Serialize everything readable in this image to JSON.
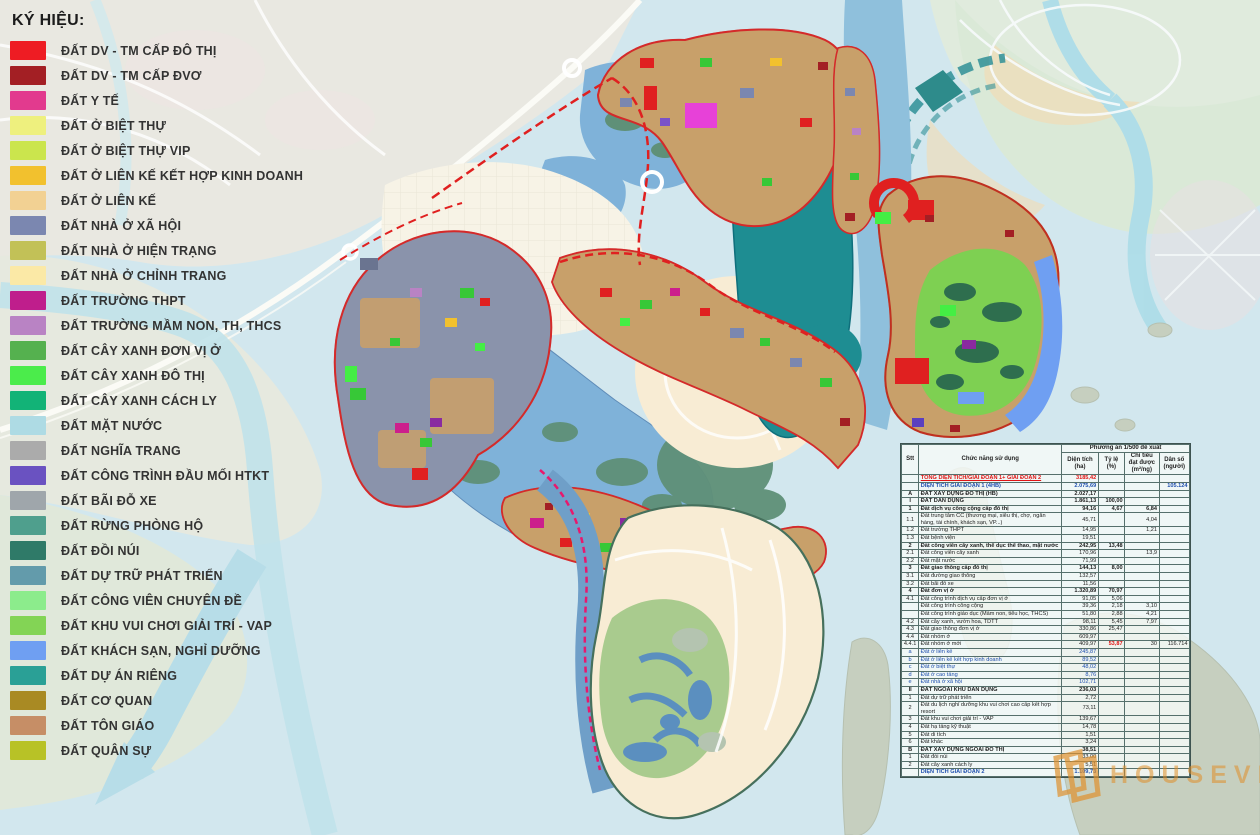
{
  "legend": {
    "title": "KÝ HIỆU:",
    "items": [
      {
        "label": "ĐẤT DV - TM CẤP ĐÔ THỊ",
        "color": "#ee1c23"
      },
      {
        "label": "ĐẤT DV - TM CẤP ĐVƠ",
        "color": "#a31f24"
      },
      {
        "label": "ĐẤT Y TẾ",
        "color": "#e23a8e"
      },
      {
        "label": "ĐẤT Ở BIỆT THỰ",
        "color": "#eef07e"
      },
      {
        "label": "ĐẤT Ở BIỆT THỰ VIP",
        "color": "#cbe54d"
      },
      {
        "label": "ĐẤT Ở LIÊN KẾ KẾT HỢP KINH DOANH",
        "color": "#f2c12e"
      },
      {
        "label": "ĐẤT Ở LIÊN KẾ",
        "color": "#f2d193"
      },
      {
        "label": "ĐẤT NHÀ Ở XÃ HỘI",
        "color": "#7b87b0"
      },
      {
        "label": "ĐẤT NHÀ Ở HIỆN TRẠNG",
        "color": "#c2c157"
      },
      {
        "label": "ĐẤT NHÀ Ở CHỈNH TRANG",
        "color": "#fbe9a6"
      },
      {
        "label": "ĐẤT TRƯỜNG THPT",
        "color": "#bf1e8c"
      },
      {
        "label": "ĐẤT TRƯỜNG MẦM NON, TH, THCS",
        "color": "#b983c4"
      },
      {
        "label": "ĐẤT CÂY XANH ĐƠN VỊ Ở",
        "color": "#55b14f"
      },
      {
        "label": "ĐẤT CÂY XANH ĐÔ THỊ",
        "color": "#4bec4b"
      },
      {
        "label": "ĐẤT CÂY XANH CÁCH LY",
        "color": "#12b377"
      },
      {
        "label": "ĐẤT MẶT NƯỚC",
        "color": "#aedbe4"
      },
      {
        "label": "ĐẤT NGHĨA TRANG",
        "color": "#ababab"
      },
      {
        "label": "ĐẤT CÔNG TRÌNH ĐẦU MỐI HTKT",
        "color": "#6a52c1"
      },
      {
        "label": "ĐẤT BÃI ĐỖ XE",
        "color": "#9fa6ab"
      },
      {
        "label": "ĐẤT RỪNG PHÒNG HỘ",
        "color": "#4f9f8d"
      },
      {
        "label": "ĐẤT ĐỒI NÚI",
        "color": "#2f7a68"
      },
      {
        "label": "ĐẤT DỰ TRỮ PHÁT TRIỂN",
        "color": "#639bab"
      },
      {
        "label": "ĐẤT CÔNG VIÊN CHUYÊN ĐỀ",
        "color": "#8cec8c"
      },
      {
        "label": "ĐẤT KHU VUI CHƠI GIẢI TRÍ - VAP",
        "color": "#83d455"
      },
      {
        "label": "ĐẤT KHÁCH SẠN, NGHỈ DƯỠNG",
        "color": "#6f9ff2"
      },
      {
        "label": "ĐẤT DỰ ÁN RIÊNG",
        "color": "#2aa096"
      },
      {
        "label": "ĐẤT CƠ QUAN",
        "color": "#a98a23"
      },
      {
        "label": "ĐẤT TÔN GIÁO",
        "color": "#c68e66"
      },
      {
        "label": "ĐẤT QUÂN SỰ",
        "color": "#b8c226"
      }
    ]
  },
  "table": {
    "header": {
      "stt": "Stt",
      "function": "Chức năng sử dụng",
      "plan": "Phương án 1/500 đề xuất",
      "cols": [
        "Diện tích (ha)",
        "Tỷ lệ (%)",
        "Chỉ tiêu đạt được (m²/ng)",
        "Dân số (người)"
      ]
    },
    "rows": [
      {
        "no": "",
        "name": "TỔNG DIỆN TÍCH/GIAI ĐOẠN 1+ GIAI ĐOẠN 2",
        "area": "3185,42",
        "ratio": "",
        "target": "",
        "pop": "",
        "style": "red"
      },
      {
        "no": "",
        "name": "DIỆN TÍCH GIAI ĐOẠN 1 (4HB)",
        "area": "2.075,69",
        "ratio": "",
        "target": "",
        "pop": "105.124",
        "style": "blue"
      },
      {
        "no": "A",
        "name": "ĐẤT XÂY DỰNG ĐÔ THỊ (HB)",
        "area": "2.027,17",
        "ratio": "",
        "target": "",
        "pop": "",
        "style": "section"
      },
      {
        "no": "I",
        "name": "ĐẤT DÂN DỤNG",
        "area": "1.861,13",
        "ratio": "100,00",
        "target": "",
        "pop": "",
        "style": "section"
      },
      {
        "no": "1",
        "name": "Đất dịch vụ công cộng cấp đô thị",
        "area": "94,16",
        "ratio": "4,67",
        "target": "6,84",
        "pop": "",
        "style": "bold"
      },
      {
        "no": "1.1",
        "name": "Đất trung tâm CC (thương mại, siêu thị, chợ, ngân hàng, tài chính, khách sạn, VP...)",
        "area": "45,71",
        "ratio": "",
        "target": "4,04",
        "pop": "",
        "style": ""
      },
      {
        "no": "1.2",
        "name": "Đất trường THPT",
        "area": "14,95",
        "ratio": "",
        "target": "1,21",
        "pop": "",
        "style": ""
      },
      {
        "no": "1.3",
        "name": "Đất bệnh viện",
        "area": "19,51",
        "ratio": "",
        "target": "",
        "pop": "",
        "style": ""
      },
      {
        "no": "2",
        "name": "Đất công viên cây xanh, thể dục thể thao, mặt nước",
        "area": "242,95",
        "ratio": "13,48",
        "target": "",
        "pop": "",
        "style": "bold"
      },
      {
        "no": "2.1",
        "name": "Đất công viên cây xanh",
        "area": "170,96",
        "ratio": "",
        "target": "13,9",
        "pop": "",
        "style": ""
      },
      {
        "no": "2.2",
        "name": "Đất mặt nước",
        "area": "71,99",
        "ratio": "",
        "target": "",
        "pop": "",
        "style": ""
      },
      {
        "no": "3",
        "name": "Đất giao thông cấp đô thị",
        "area": "144,13",
        "ratio": "8,00",
        "target": "",
        "pop": "",
        "style": "bold"
      },
      {
        "no": "3.1",
        "name": "Đất đường giao thông",
        "area": "132,57",
        "ratio": "",
        "target": "",
        "pop": "",
        "style": ""
      },
      {
        "no": "3.2",
        "name": "Đất bãi đỗ xe",
        "area": "11,56",
        "ratio": "",
        "target": "",
        "pop": "",
        "style": ""
      },
      {
        "no": "4",
        "name": "Đất đơn vị ở",
        "area": "1.320,89",
        "ratio": "70,97",
        "target": "",
        "pop": "",
        "style": "bold"
      },
      {
        "no": "4.1",
        "name": "Đất công trình dịch vụ cấp đơn vị ở",
        "area": "91,05",
        "ratio": "5,06",
        "target": "",
        "pop": "",
        "style": ""
      },
      {
        "no": "",
        "name": "Đất công trình công cộng",
        "area": "39,36",
        "ratio": "2,18",
        "target": "3,10",
        "pop": "",
        "style": ""
      },
      {
        "no": "",
        "name": "Đất công trình giáo dục (Mầm non, tiểu học, THCS)",
        "area": "51,80",
        "ratio": "2,88",
        "target": "4,21",
        "pop": "",
        "style": ""
      },
      {
        "no": "4.2",
        "name": "Đất cây xanh, vườn hoa, TDTT",
        "area": "98,11",
        "ratio": "5,45",
        "target": "7,97",
        "pop": "",
        "style": ""
      },
      {
        "no": "4.3",
        "name": "Đất giao thông đơn vị ở",
        "area": "330,86",
        "ratio": "25,47",
        "target": "",
        "pop": "",
        "style": ""
      },
      {
        "no": "4.4",
        "name": "Đất nhóm ở",
        "area": "609,97",
        "ratio": "",
        "target": "",
        "pop": "",
        "style": ""
      },
      {
        "no": "4.4.1",
        "name": "Đất nhóm ở mới",
        "area": "409,97",
        "ratio": "53,87",
        "target": "30",
        "pop": "116.714",
        "style": "",
        "ratio_red": true
      },
      {
        "no": "a",
        "name": "Đất ở liên kế",
        "area": "245,87",
        "ratio": "",
        "target": "",
        "pop": "",
        "style": "bluesub"
      },
      {
        "no": "b",
        "name": "Đất ở liên kế kết hợp kinh doanh",
        "area": "89,52",
        "ratio": "",
        "target": "",
        "pop": "",
        "style": "bluesub"
      },
      {
        "no": "c",
        "name": "Đất ở biệt thự",
        "area": "48,02",
        "ratio": "",
        "target": "",
        "pop": "",
        "style": "bluesub"
      },
      {
        "no": "d",
        "name": "Đất ở cao tầng",
        "area": "8,76",
        "ratio": "",
        "target": "",
        "pop": "",
        "style": "bluesub"
      },
      {
        "no": "e",
        "name": "Đất nhà ở xã hội",
        "area": "102,71",
        "ratio": "",
        "target": "",
        "pop": "",
        "style": "bluesub"
      },
      {
        "no": "II",
        "name": "ĐẤT NGOÀI KHU DÂN DỤNG",
        "area": "236,03",
        "ratio": "",
        "target": "",
        "pop": "",
        "style": "section"
      },
      {
        "no": "1",
        "name": "Đất dự trữ phát triển",
        "area": "2,72",
        "ratio": "",
        "target": "",
        "pop": "",
        "style": ""
      },
      {
        "no": "2",
        "name": "Đất du lịch nghỉ dưỡng khu vui chơi cao cấp kết hợp resort",
        "area": "73,11",
        "ratio": "",
        "target": "",
        "pop": "",
        "style": ""
      },
      {
        "no": "3",
        "name": "Đất khu vui chơi giải trí - VAP",
        "area": "139,67",
        "ratio": "",
        "target": "",
        "pop": "",
        "style": ""
      },
      {
        "no": "4",
        "name": "Đất hạ tầng kỹ thuật",
        "area": "14,78",
        "ratio": "",
        "target": "",
        "pop": "",
        "style": ""
      },
      {
        "no": "5",
        "name": "Đất di tích",
        "area": "1,51",
        "ratio": "",
        "target": "",
        "pop": "",
        "style": ""
      },
      {
        "no": "6",
        "name": "Đất khác",
        "area": "3,24",
        "ratio": "",
        "target": "",
        "pop": "",
        "style": ""
      },
      {
        "no": "B",
        "name": "ĐẤT XÂY DỰNG NGOÀI ĐÔ THỊ",
        "area": "38,51",
        "ratio": "",
        "target": "",
        "pop": "",
        "style": "section"
      },
      {
        "no": "1",
        "name": "Đất đồi núi",
        "area": "33,00",
        "ratio": "",
        "target": "",
        "pop": "",
        "style": ""
      },
      {
        "no": "2",
        "name": "Đất cây xanh cách ly",
        "area": "5,51",
        "ratio": "",
        "target": "",
        "pop": "",
        "style": ""
      },
      {
        "no": "",
        "name": "DIỆN TÍCH GIAI ĐOẠN 2",
        "area": "1.109,73",
        "ratio": "",
        "target": "",
        "pop": "",
        "style": "blue"
      }
    ]
  },
  "watermark": {
    "text": "HOUSEVIET",
    "color": "#e08e28"
  }
}
